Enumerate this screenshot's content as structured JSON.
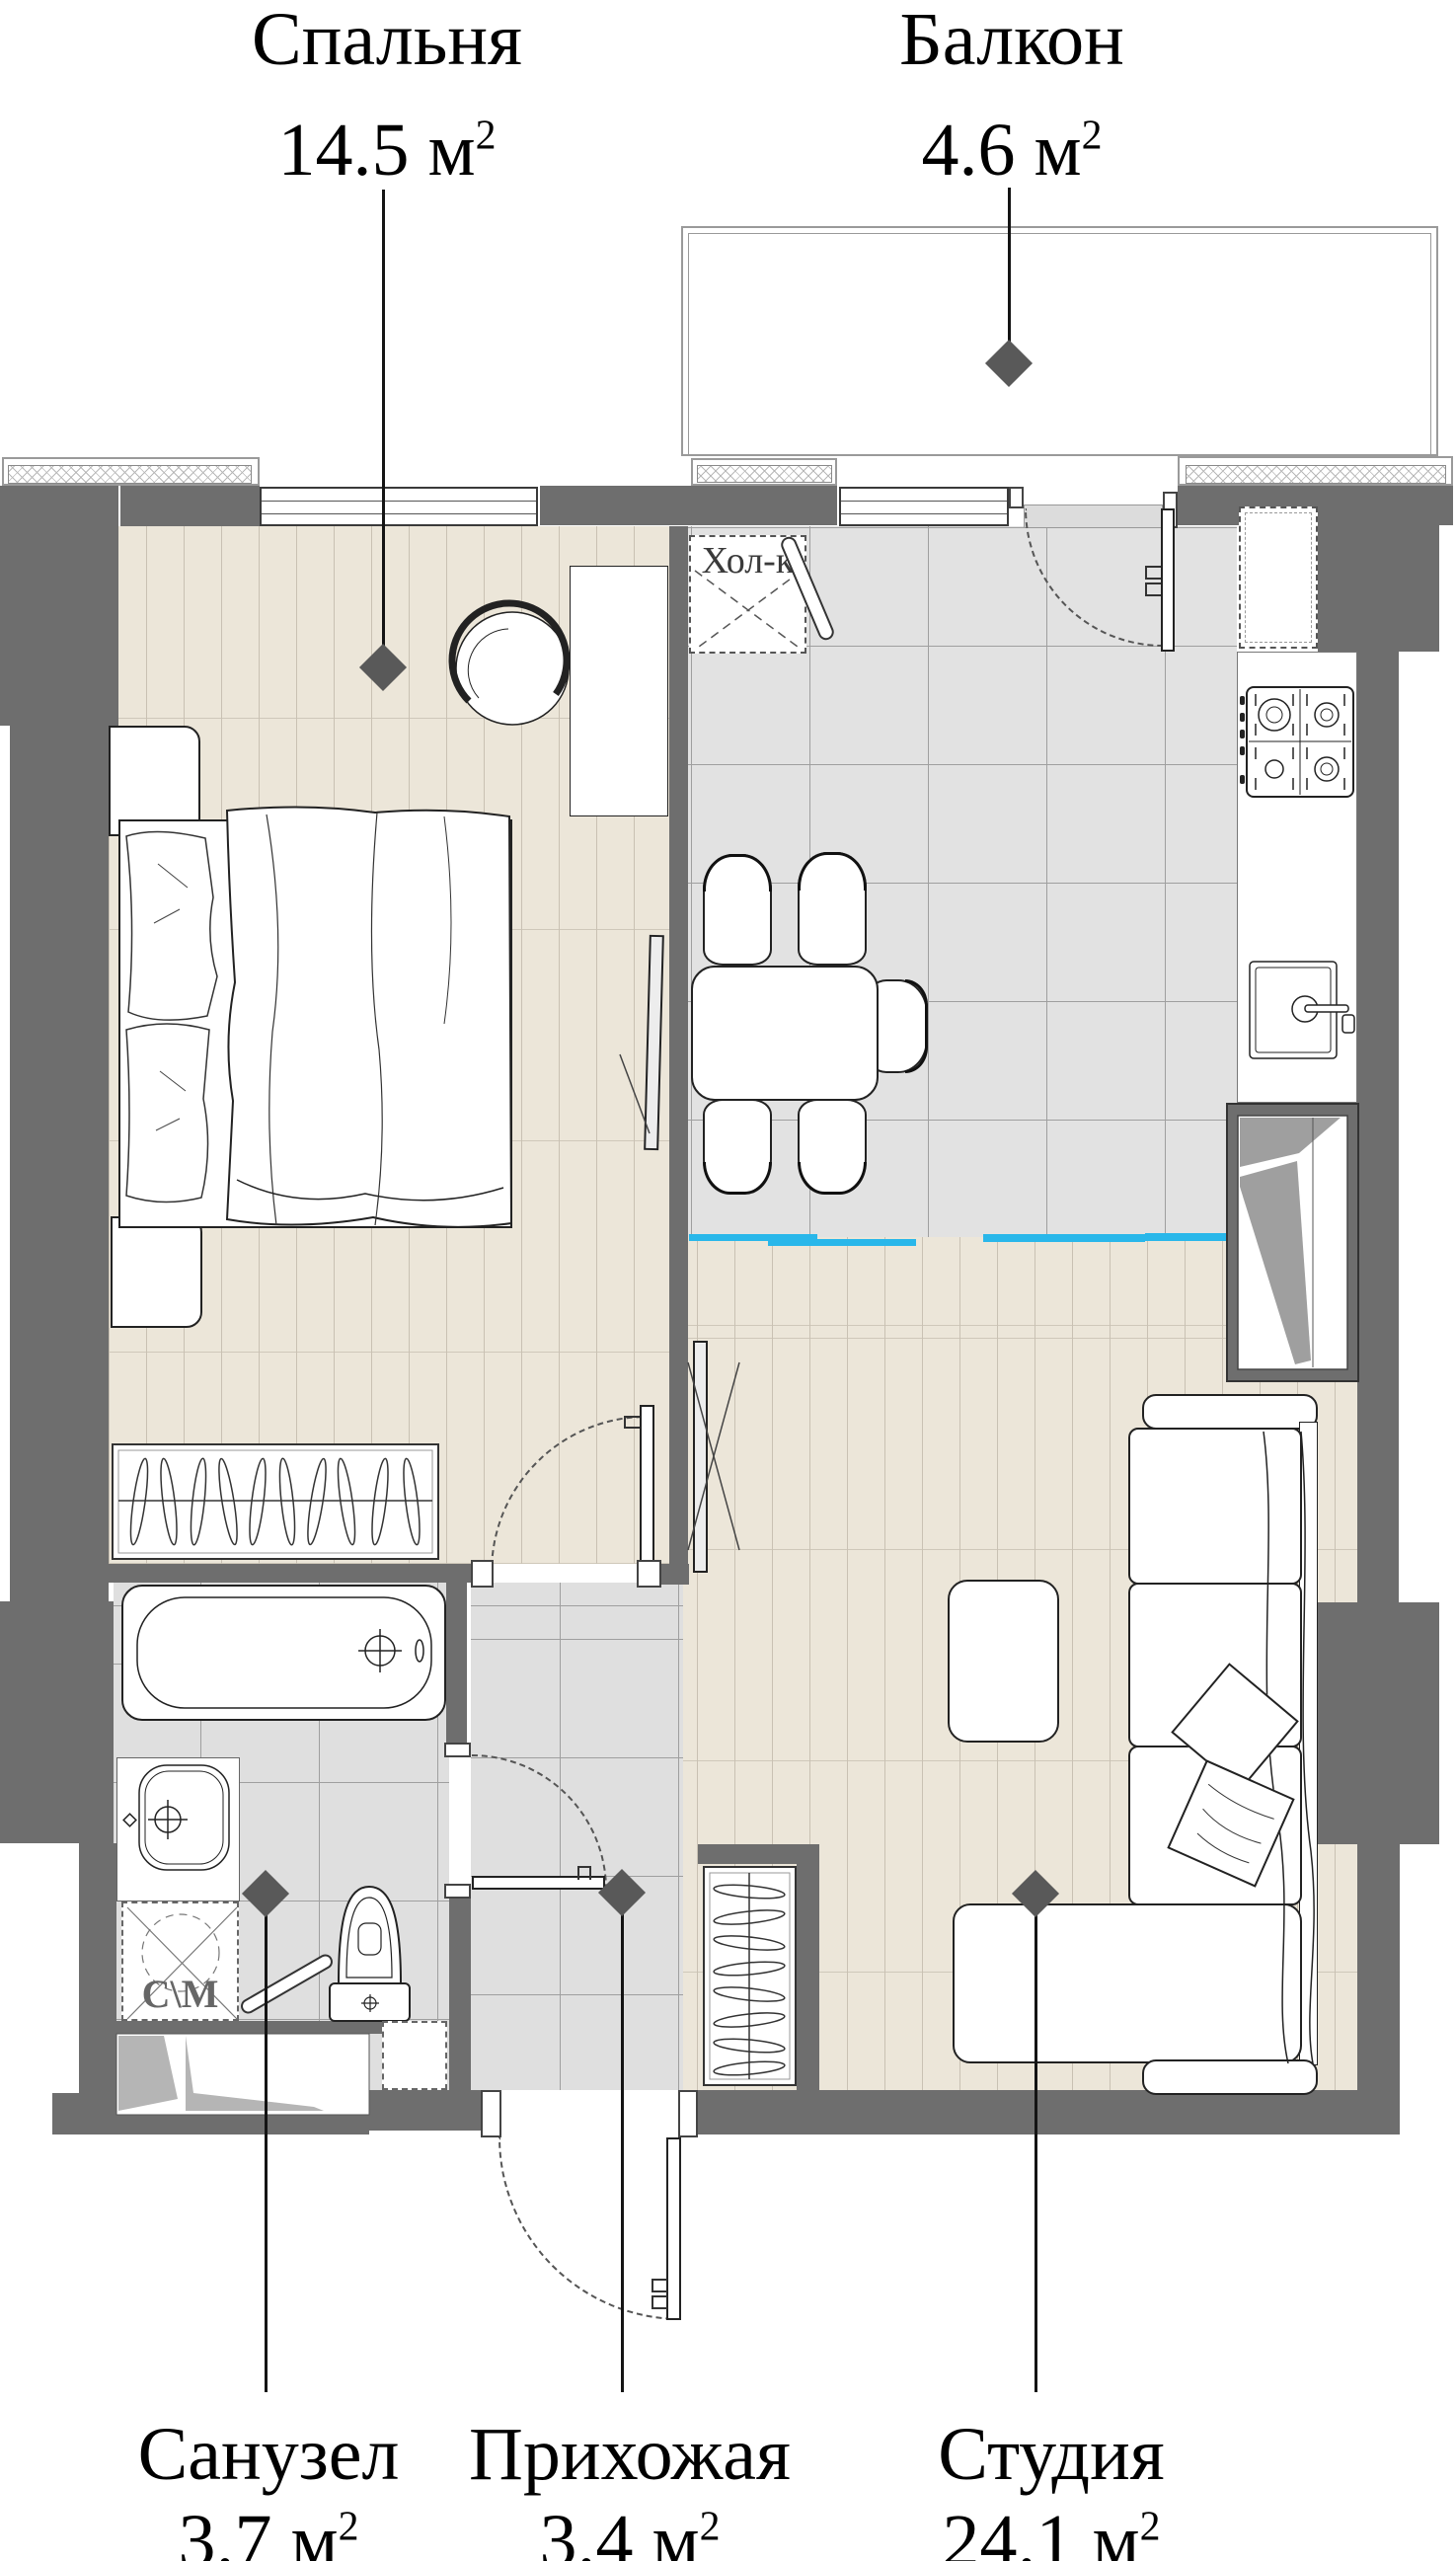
{
  "rooms": {
    "bedroom": {
      "name": "Спальня",
      "area": "14.5",
      "unit": "м",
      "sup": "2"
    },
    "balcony": {
      "name": "Балкон",
      "area": "4.6",
      "unit": "м",
      "sup": "2"
    },
    "bathroom": {
      "name": "Санузел",
      "area": "3.7",
      "unit": "м",
      "sup": "2"
    },
    "hallway": {
      "name": "Прихожая",
      "area": "3.4",
      "unit": "м",
      "sup": "2"
    },
    "studio": {
      "name": "Студия",
      "area": "24.1",
      "unit": "м",
      "sup": "2"
    }
  },
  "fixtures": {
    "fridge_label": "Хол-к",
    "washer_label": "С\\М"
  },
  "colors": {
    "wall": "#6e6e6e",
    "accent_blue": "#29b7ea",
    "floor_wood": "#ece6d9",
    "floor_tile": "#e2e2e2",
    "marker": "#595959",
    "text": "#111111"
  }
}
